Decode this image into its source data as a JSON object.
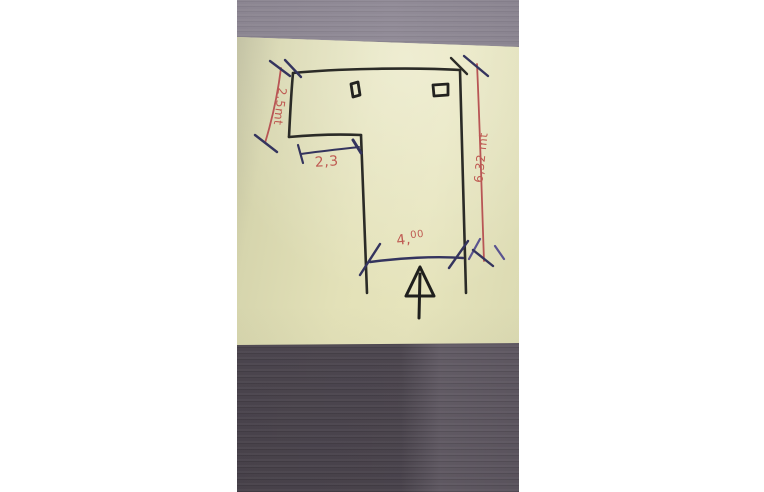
{
  "sketch": {
    "labels": {
      "left_height": "2,5mt",
      "notch_width": "2,3",
      "bottom_width_main": "4,",
      "bottom_width_sup": "00",
      "right_height": "6,32 mt"
    },
    "symbols": {
      "entrance_arrow": "up-arrow at door opening",
      "window_left": "small square on top wall",
      "window_right": "small square on top wall"
    },
    "colors": {
      "wall_ink": "#2b2b27",
      "dimension_blue": "#34345e",
      "dimension_purple": "#5a5490",
      "annotation_red": "#bf5a52",
      "note_yellow": "#dedcb2",
      "wood_top": "#8d8793",
      "wood_bottom": "#5e5761",
      "page_background": "#ffffff"
    }
  }
}
